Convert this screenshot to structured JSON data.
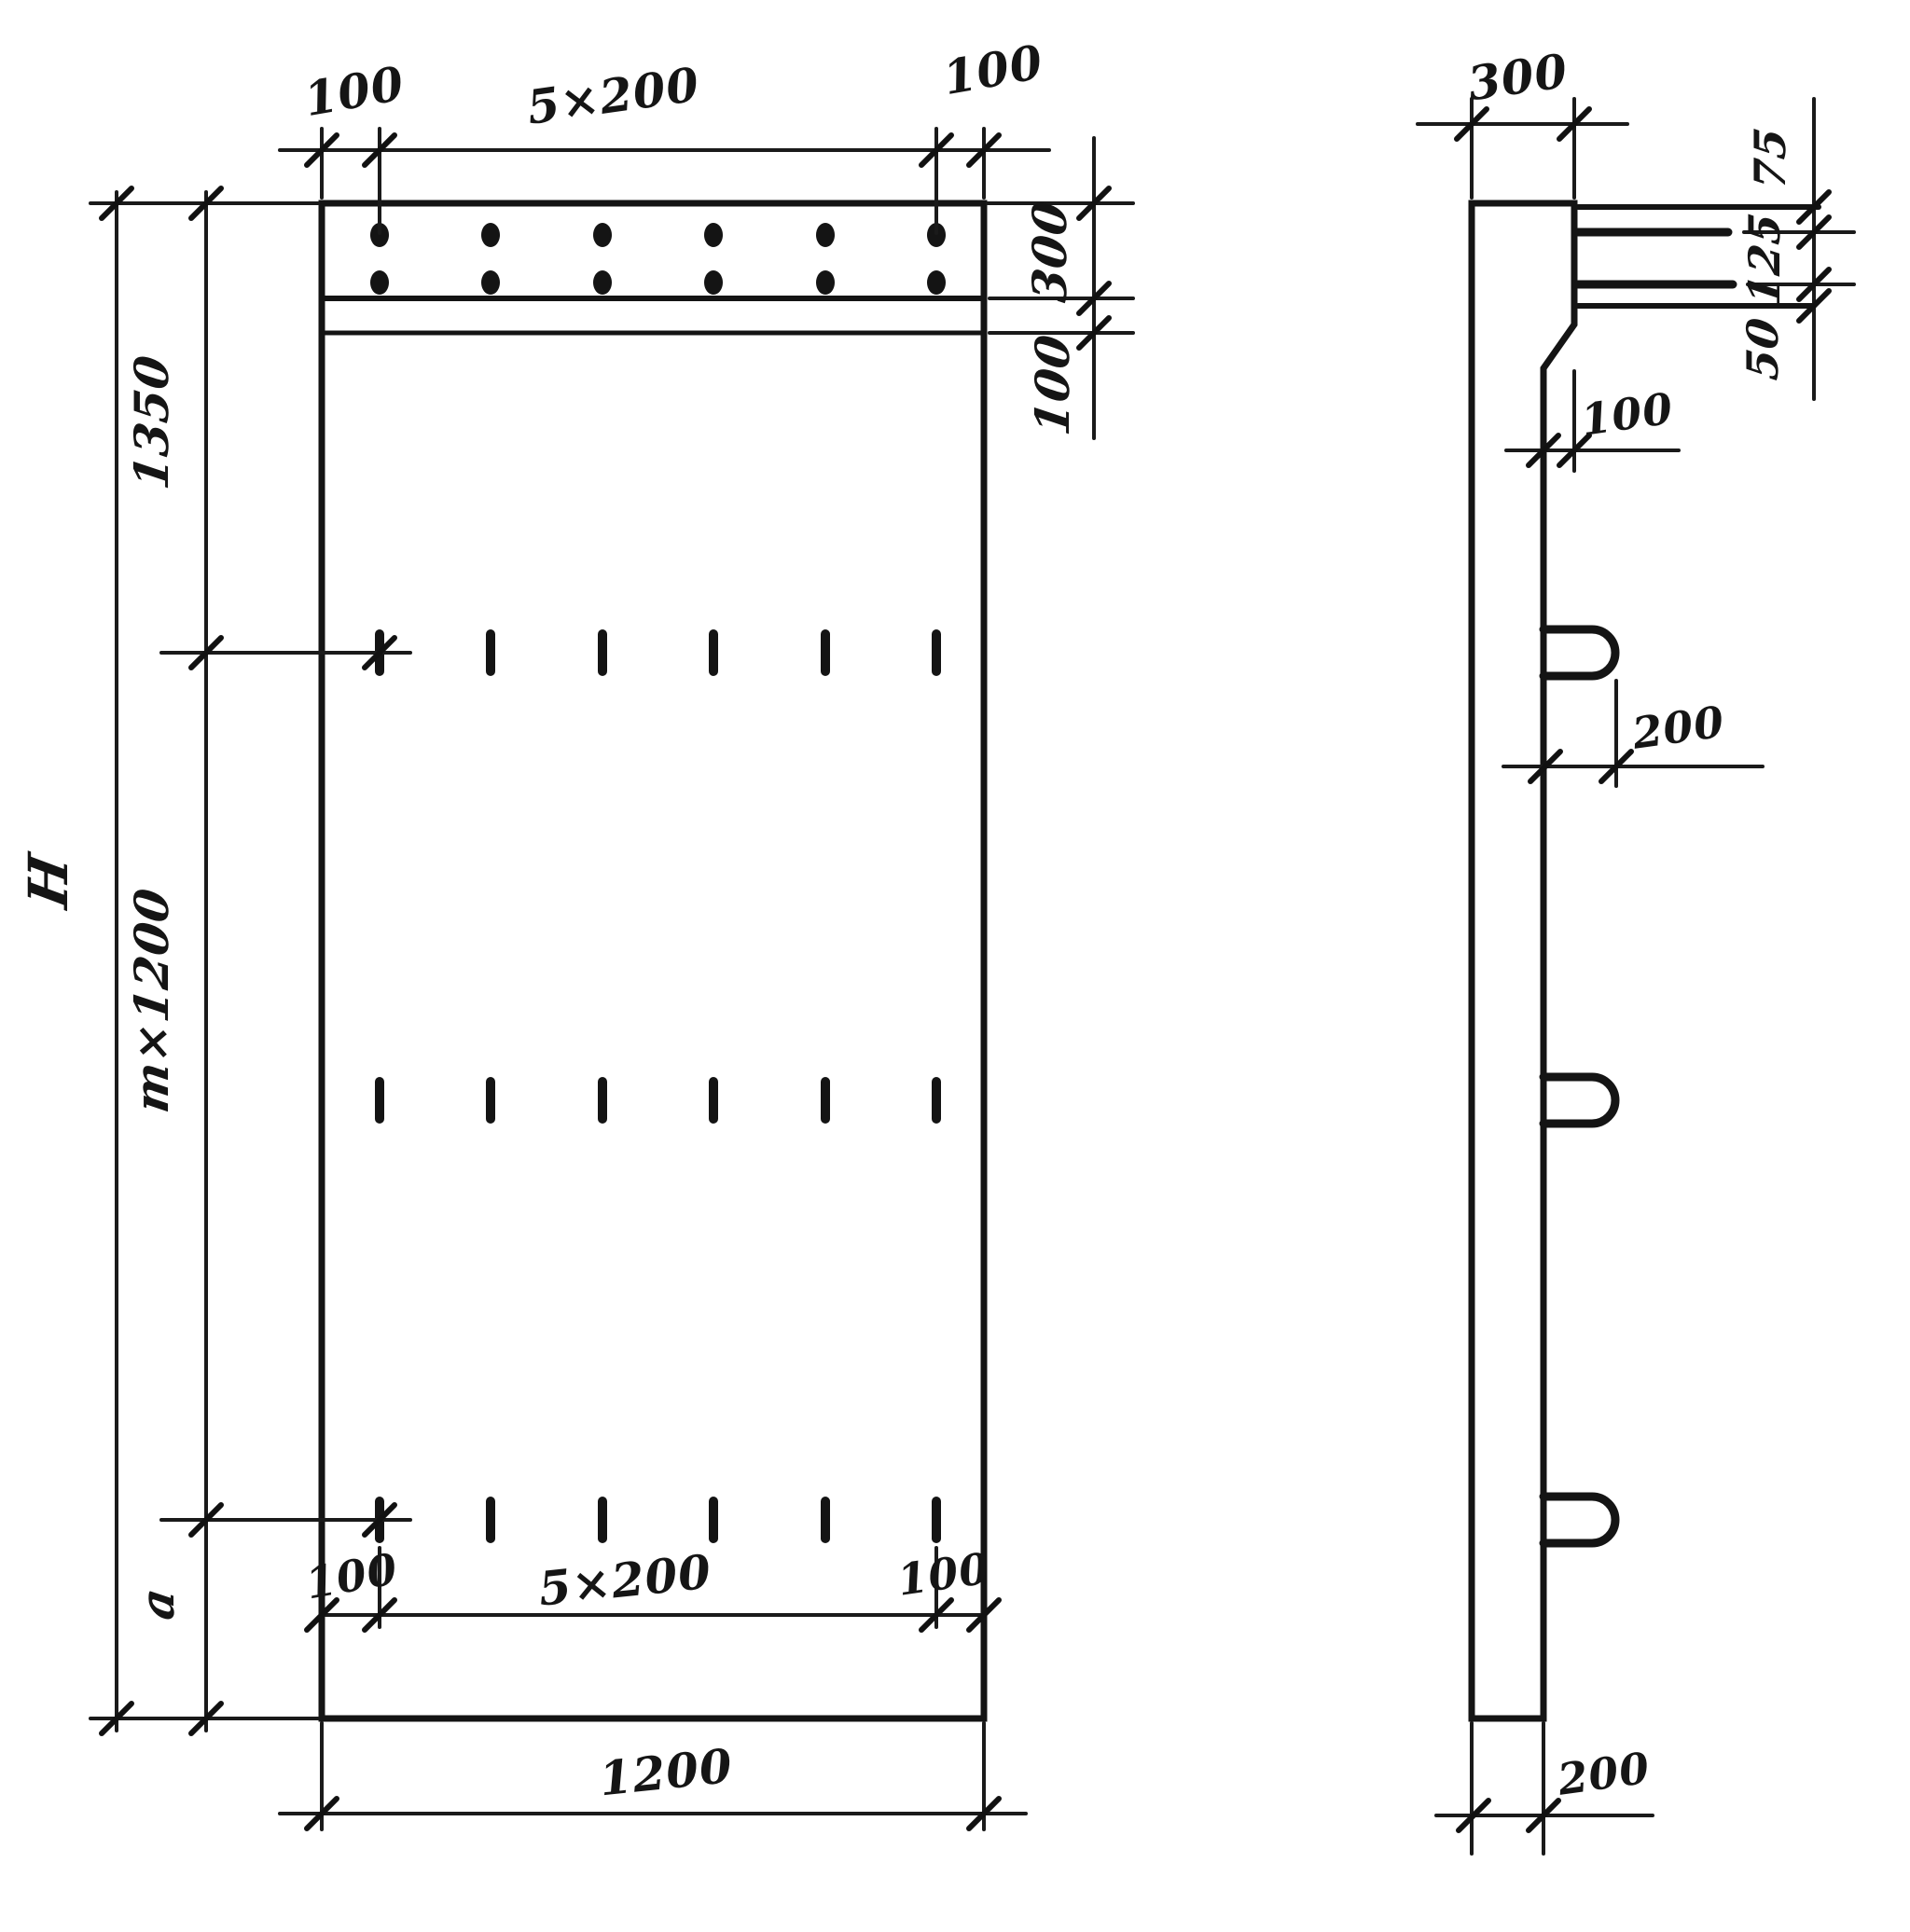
{
  "page": {
    "background": "#ffffff",
    "ink": "#141414"
  },
  "front_view": {
    "top": {
      "left_margin": "100",
      "hole_spacing": "5×200",
      "right_margin": "100"
    },
    "right": {
      "anchor_band_height": "300",
      "strip_height": "100"
    },
    "left": {
      "overall_height": "H",
      "top_segment": "1350",
      "middle_segment": "m×1200",
      "bottom_segment": "a"
    },
    "bottom": {
      "left_margin": "100",
      "hole_spacing": "5×200",
      "right_margin": "100",
      "panel_width": "1200"
    }
  },
  "side_view": {
    "top": {
      "width": "300"
    },
    "right": {
      "bar_offset": "75",
      "bar_gap": "125",
      "bar_height": "50"
    },
    "chamfer": {
      "offset": "100"
    },
    "loop": {
      "length": "200"
    },
    "bottom": {
      "width": "200"
    }
  }
}
